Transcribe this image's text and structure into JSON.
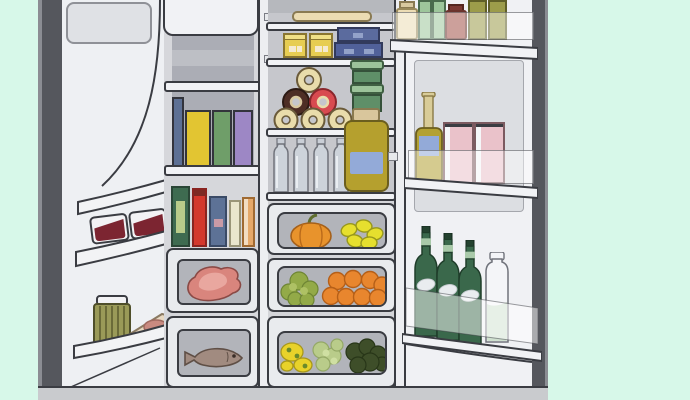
{
  "illustration": {
    "label": "Open side-by-side refrigerator fully stocked with food",
    "background_color": "#d7f8e9",
    "outline_color": "#3a3c42",
    "fridge_body_color": "#eef0f3",
    "interior_wall_color": "#c6c7cc",
    "base_color": "#c9cbce"
  },
  "left_door": {
    "label": "open left refrigerator door",
    "upper_bin": {
      "label": "door bin with two jam jars",
      "items": [
        "jam jar",
        "jam jar"
      ],
      "jar_lid_color": "#f2f2f4",
      "jam_color": "#7c2531"
    },
    "lower_bin": {
      "label": "door bin with ribbed jar and wrapped ham wedge",
      "items": [
        "ribbed condiment jar",
        "wrapped ham wedge"
      ],
      "jar_color": "#9a9a58",
      "ham_color": "#e8d8c0"
    }
  },
  "left_compartment": {
    "label": "left fridge section with shelves and drawers",
    "carton_shelf": {
      "label": "shelf with four tall cartons",
      "items": [
        {
          "name": "blue slim carton",
          "color": "#5d7094"
        },
        {
          "name": "yellow carton",
          "color": "#e2c532"
        },
        {
          "name": "green carton",
          "color": "#6f9e69"
        },
        {
          "name": "purple carton",
          "color": "#9d87c5"
        }
      ]
    },
    "bottle_shelf": {
      "label": "shelf with bottles and boxes",
      "items": [
        {
          "name": "green box with label",
          "color": "#3e6b50"
        },
        {
          "name": "red bottle",
          "color": "#d3382d"
        },
        {
          "name": "blue bottle with pink label",
          "color": "#5d7296"
        },
        {
          "name": "cream bottle",
          "color": "#eae6cd"
        },
        {
          "name": "orange carton",
          "color": "#e5a869"
        }
      ]
    },
    "meat_drawer": {
      "label": "drawer with raw meat",
      "content": "raw meat",
      "color": "#d9857d"
    },
    "fish_drawer": {
      "label": "drawer with whole fish",
      "content": "whole fish",
      "color": "#a18b80"
    }
  },
  "center_compartment": {
    "label": "center fridge section",
    "top_shelf": {
      "label": "top shelf with serving tray",
      "items": [
        "cream serving tray"
      ]
    },
    "box_shelf": {
      "label": "shelf with boxes",
      "items": [
        "yellow box",
        "yellow box",
        "stacked blue boxes"
      ]
    },
    "bagel_shelf": {
      "label": "shelf with stacked bagels and food containers",
      "items": [
        "plain bagel x4",
        "chocolate bagel",
        "red-iced bagel",
        "stacked green food containers"
      ]
    },
    "bottle_shelf": {
      "label": "shelf with water bottles and large jar",
      "items": [
        "water bottle x4",
        "large olive jar with blue label"
      ]
    },
    "drawer_pumpkin_lemons": {
      "label": "produce drawer",
      "contents": [
        "pumpkin",
        "lemons"
      ]
    },
    "drawer_broccoli_oranges": {
      "label": "produce drawer",
      "contents": [
        "broccoli",
        "oranges"
      ]
    },
    "drawer_greens": {
      "label": "crisper drawer",
      "contents": [
        "yellow peppers",
        "lettuce",
        "dark leafy greens"
      ]
    }
  },
  "right_door": {
    "label": "open right refrigerator door",
    "top_shelf": {
      "label": "door shelf with jars",
      "items": [
        {
          "name": "cream jar",
          "color": "#ecdcb4"
        },
        {
          "name": "green jar",
          "color": "#9dc69b"
        },
        {
          "name": "green jar",
          "color": "#9dc69b"
        },
        {
          "name": "red-brown jar",
          "color": "#a35249"
        },
        {
          "name": "olive jar",
          "color": "#9c9c4a"
        },
        {
          "name": "olive jar",
          "color": "#9c9c4a"
        }
      ]
    },
    "middle_shelf": {
      "label": "door shelf with bottle and cartons",
      "items": [
        {
          "name": "oil bottle with blue label",
          "color": "#b3a133"
        },
        {
          "name": "pink carton",
          "color": "#eac2ca"
        },
        {
          "name": "pink carton",
          "color": "#eac2ca"
        }
      ]
    },
    "bottom_shelf": {
      "label": "door shelf with bottles",
      "items": [
        {
          "name": "green glass bottle",
          "color": "#3a684b"
        },
        {
          "name": "green glass bottle",
          "color": "#3a684b"
        },
        {
          "name": "green glass bottle",
          "color": "#3a684b"
        },
        {
          "name": "milk bottle",
          "color": "#f4f5f8"
        }
      ]
    }
  }
}
